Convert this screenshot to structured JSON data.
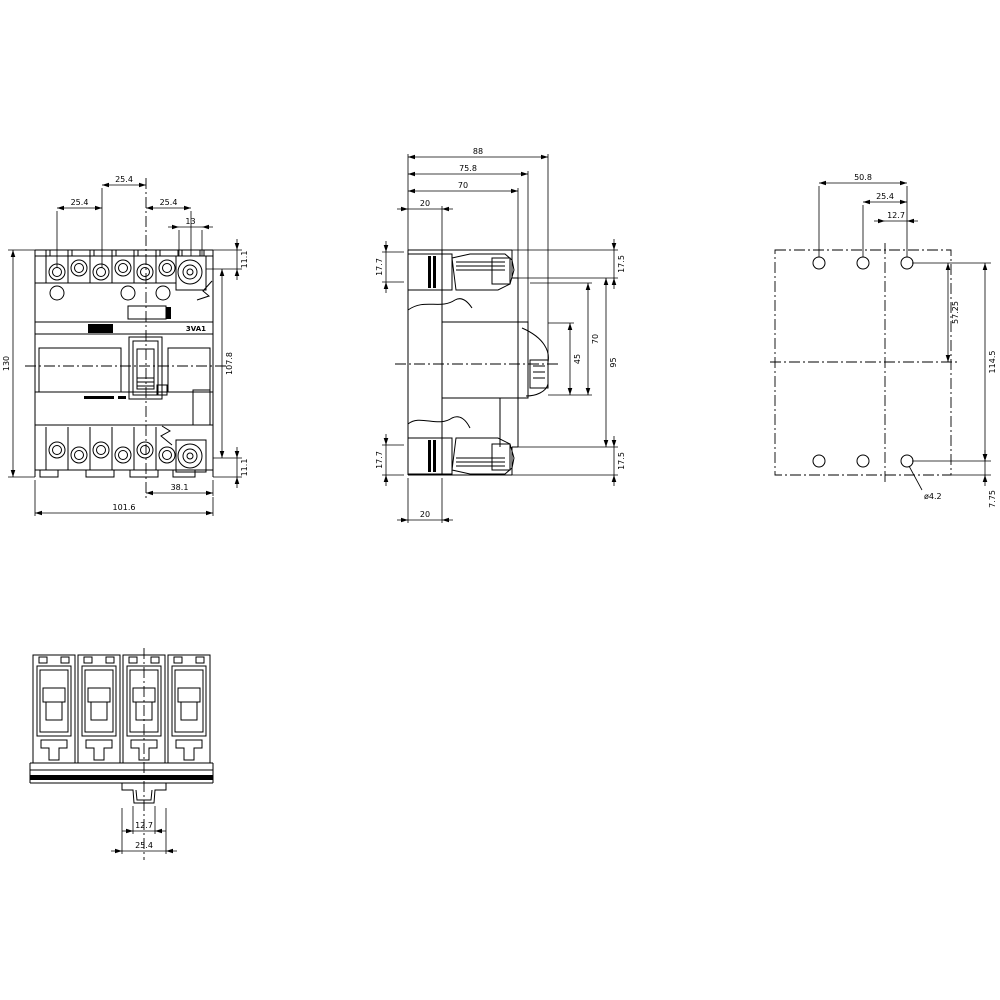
{
  "product_label": "3VA1",
  "colors": {
    "line": "#000000",
    "background": "#ffffff"
  },
  "views": {
    "front": {
      "dims": {
        "pitch_center": "25.4",
        "pitch_left": "25.4",
        "pitch_right": "25.4",
        "term_width": "13",
        "term_h_top": "11.1",
        "height_total": "130",
        "height_cover": "107.8",
        "term_h_bottom": "11.1",
        "width_right": "38.1",
        "width_total": "101.6"
      }
    },
    "side": {
      "dims": {
        "depth_total": "88",
        "depth_handle": "75.8",
        "depth_body": "70",
        "top_offset": "20",
        "term_top": "17.7",
        "term_bottom": "17.7",
        "bottom_offset": "20",
        "cover_top": "17.5",
        "front_70": "70",
        "front_45": "45",
        "front_95": "95",
        "cover_bottom": "17.5"
      }
    },
    "drill": {
      "dims": {
        "span": "50.8",
        "pitch": "25.4",
        "half_pitch": "12.7",
        "upper_v": "57.25",
        "vertical_span": "114.5",
        "edge_offset": "7.75",
        "hole_dia": "ø4.2"
      }
    },
    "bottom": {
      "dims": {
        "clip_half": "12.7",
        "clip_width": "25.4"
      }
    }
  }
}
